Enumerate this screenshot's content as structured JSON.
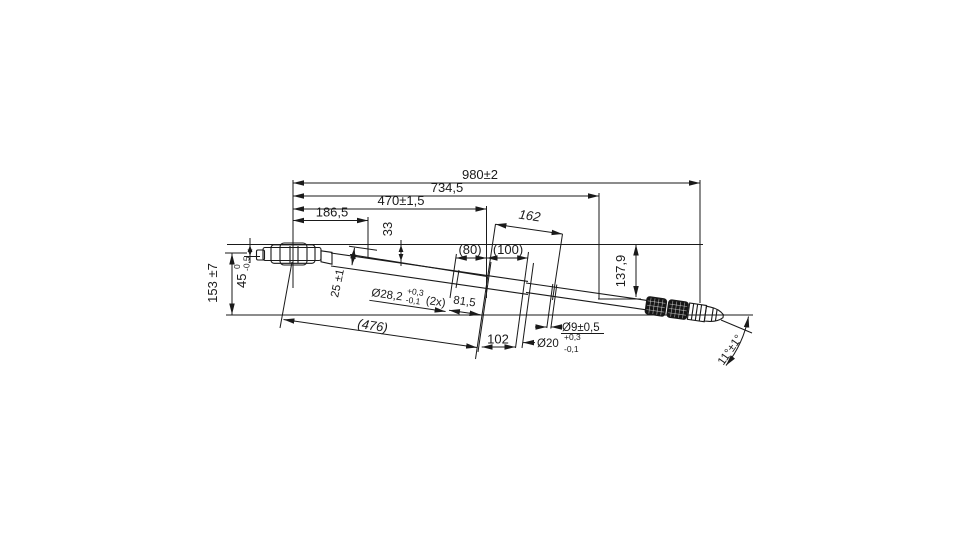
{
  "drawing": {
    "colors": {
      "ink": "#1a1a1a",
      "background": "#ffffff"
    },
    "labels": {
      "total_length": "980±2",
      "length_734": "734,5",
      "length_470": "470±1,5",
      "length_186": "186,5",
      "offset_33": "33",
      "length_162": "162",
      "length_80": "(80)",
      "length_100": "(100)",
      "drop_137": "137,9",
      "height_153": "153 ±7",
      "dim45": {
        "value": "45",
        "tol_upper": "0",
        "tol_lower": "-0,5"
      },
      "dim25": "25 ±1",
      "dia28": {
        "value": "Ø28,2",
        "tol_upper": "+0,3",
        "tol_lower": "-0,1",
        "count": "(2x)"
      },
      "length_81": "81,5",
      "length_476": "(476)",
      "length_102": "102",
      "dia9": "Ø9±0,5",
      "dia20": {
        "value": "Ø20",
        "tol_upper": "+0,3",
        "tol_lower": "-0,1"
      },
      "angle": "11°±1°"
    }
  }
}
